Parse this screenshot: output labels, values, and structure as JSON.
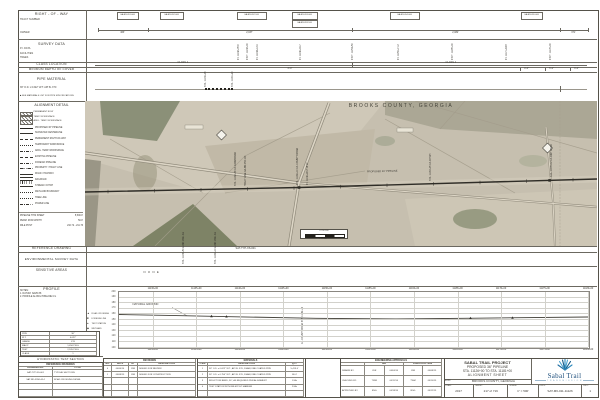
{
  "colors": {
    "paper": "#ffffff",
    "line": "#58554c",
    "map_base": "#c6bfaf",
    "woods": "#83886c",
    "pipeline": "#2f2d27",
    "brand_blue": "#1d4e7c",
    "brand_light": "#6d97b8",
    "grid": "#cfcec9"
  },
  "header": {
    "row_title": "RIGHT - OF - WAY",
    "row_sub1": "TRACT NUMBER",
    "row_sub2": "OWNER",
    "survey_title": "SURVEY DATA",
    "survey_sub1": "P.I. DATA",
    "survey_sub2": "FACILITIES",
    "survey_sub3": "TREES",
    "class_title": "CLASS LOCATION",
    "class_left": "CLASS 1",
    "class_right": "CLASS 1",
    "depth_title": "MINIMUM DEPTH OF COVER",
    "depth_main": "3'-0\"",
    "pipe_title": "PIPE MATERIAL",
    "pipe_item": "36\" O.D. x 0.622\" W.T. API 5L X70",
    "pipe_note": "■ SEE MATERIALS LIST FOR PIPE SPECIFICATIONS",
    "pipe_callout1": "STA. 11139+05",
    "pipe_callout2": "STA. 11141+90"
  },
  "row_tracts": {
    "boxes": [
      {
        "x": 31,
        "w": 20,
        "label": "GA-BR-051.000"
      },
      {
        "x": 74,
        "w": 22,
        "label": "GA-BR-052.000"
      },
      {
        "x": 151,
        "w": 28,
        "label": "GA-BR-052.100"
      },
      {
        "x": 206,
        "w": 24,
        "label": "GA-BR-053.000",
        "label2": "GA-BR-053.100"
      },
      {
        "x": 304,
        "w": 28,
        "label": "GA-BR-054.000"
      },
      {
        "x": 435,
        "w": 20,
        "label": "GA-BR-055.000"
      }
    ],
    "ticks": [
      12,
      62,
      266,
      474,
      502
    ],
    "dims": [
      {
        "x": 37,
        "t": "463'"
      },
      {
        "x": 164,
        "t": "2,037'"
      },
      {
        "x": 370,
        "t": "2,082'"
      },
      {
        "x": 488,
        "t": "371'"
      }
    ]
  },
  "survey": {
    "callouts": [
      {
        "x": 152,
        "t": "P.I. 11142+35.6"
      },
      {
        "x": 161,
        "t": "P.O.T. 11143+00"
      },
      {
        "x": 171,
        "t": "P.I. 11144+12.9"
      },
      {
        "x": 214,
        "t": "P.I. 11149+09.7"
      },
      {
        "x": 266,
        "t": "P.O.T. 11154+50"
      },
      {
        "x": 312,
        "t": "P.I. 11159+71.2"
      },
      {
        "x": 366,
        "t": "P.O.T. 11165+00"
      },
      {
        "x": 420,
        "t": "P.I. 11171+44.8"
      },
      {
        "x": 464,
        "t": "P.O.T. 11176+00"
      }
    ]
  },
  "depth_marks": [
    {
      "x": 441,
      "t": "4'-0\""
    },
    {
      "x": 466,
      "t": "5'-0\""
    },
    {
      "x": 491,
      "t": "3'-0\""
    }
  ],
  "legend": {
    "title": "ALIGNMENT DETAIL",
    "hatch": [
      {
        "t": "PERMANENT ROW"
      },
      {
        "t": "TEMP. WORKSPACE"
      },
      {
        "t": "ADDL. TEMP. WORKSPACE"
      }
    ],
    "items": [
      {
        "s": "thick",
        "t": "PROPOSED 36\" PIPELINE"
      },
      {
        "s": "solid",
        "t": "SURVEYED CENTERLINE"
      },
      {
        "s": "dashed",
        "t": "PERMANENT RIGHT-OF-WAY"
      },
      {
        "s": "dotted",
        "t": "TEMPORARY WORKSPACE"
      },
      {
        "s": "dashdot",
        "t": "ADDL. TEMP. WORKSPACE"
      },
      {
        "s": "dashed",
        "t": "EXISTING PIPELINE"
      },
      {
        "s": "dashdot",
        "t": "FOREIGN PIPELINE"
      },
      {
        "s": "dashdotdot",
        "t": "PROPERTY / TRACT LINE"
      },
      {
        "s": "double",
        "t": "ROAD / HIGHWAY"
      },
      {
        "s": "hatchline",
        "t": "RAILROAD"
      },
      {
        "s": "solid",
        "t": "STREAM / DITCH"
      },
      {
        "s": "dotted",
        "t": "WETLAND BOUNDARY"
      },
      {
        "s": "dotted",
        "t": "TREE LINE"
      },
      {
        "s": "dashdot",
        "t": "POWER LINE"
      }
    ],
    "totals": [
      {
        "l": "PIPELINE THIS SHEET",
        "v": "5,500.0'"
      },
      {
        "l": "PERM. ROW WIDTH",
        "v": "50.0'"
      },
      {
        "l": "MILE POST",
        "v": "210.72 - 211.76"
      }
    ]
  },
  "map": {
    "county": "BROOKS COUNTY, GEORGIA",
    "pipeline_label": "PROPOSED 36\" PIPELINE",
    "scale_nums": "0        250       500",
    "scale_text": "1\" = 500'",
    "callouts": [
      {
        "x": 150,
        "t": "STA. 11142+36  C/L FARM ROAD"
      },
      {
        "x": 160,
        "t": "TRACT LINE  GA-BR-052.100"
      },
      {
        "x": 212,
        "t": "STA. 11149+10  C/L COUNTY ROAD"
      },
      {
        "x": 222,
        "t": "P.I. 11149+96  2°14' LT."
      },
      {
        "x": 345,
        "t": "STA. 11163+05  C/L DITCH"
      },
      {
        "x": 466,
        "t": "STA. 11176+12  C/L DIRT ROAD"
      }
    ]
  },
  "bands": {
    "refdwg_title": "REFERENCE DRAWING",
    "refdwg_note": "SAT-TYP-XS-001",
    "env_title": "ENVIRONMENTAL SURVEY DATA",
    "env_callouts": [
      {
        "x": 97,
        "t": "STA. 11136+50  LAND USE: AG"
      },
      {
        "x": 129,
        "t": "STA. 11140+10  LAND USE: AG"
      }
    ],
    "sens_title": "SENSITIVE AREAS",
    "sens_value": "N O N E"
  },
  "profile": {
    "title": "PROFILE",
    "notes": [
      "NOTES:",
      "1. DATUM: NAVD 88",
      "2. PROFILE ALONG PIPELINE C/L"
    ],
    "symbols": [
      {
        "m": "▲",
        "t": "ROAD CROSSING"
      },
      {
        "m": "■",
        "t": "FOREIGN LINE"
      },
      {
        "m": "●",
        "t": "TEST STATION"
      },
      {
        "m": "◆",
        "t": "WETLAND"
      }
    ],
    "table": [
      [
        "PIPE",
        "36\""
      ],
      [
        "W.T.",
        "0.622\""
      ],
      [
        "GRADE",
        "X70"
      ],
      [
        "MAOP",
        "1,456 PSIG"
      ],
      [
        "TEST",
        "2,185 PSIG"
      ],
      [
        "CLASS",
        "1"
      ]
    ],
    "elevations": [
      "200",
      "190",
      "180",
      "170",
      "160",
      "150",
      "140",
      "130",
      "120",
      "110",
      "100"
    ],
    "stations": [
      "11130+00",
      "11135+00",
      "11140+00",
      "11145+00",
      "11150+00",
      "11155+00",
      "11160+00",
      "11165+00",
      "11170+00",
      "11175+00",
      "11180+00"
    ],
    "ground_label": "NATURAL GROUND",
    "crossing_callout": "C/L COUNTY ROAD  STA. 11149+10",
    "ground_elev_ft": 155
  },
  "hydro_title": "HYDROSTATIC TEST SECTION",
  "refdwgs": {
    "title": "REFERENCE DRAWINGS",
    "cols": [
      "DRAWING NO.",
      "TITLE"
    ],
    "rows": [
      [
        "SAT-TYP-XS-001",
        "TYPICAL SECTIONS"
      ],
      [
        "SAT-RD-XING-014",
        "ROAD CROSSING DETAIL"
      ],
      [
        "",
        ""
      ],
      [
        "",
        ""
      ]
    ]
  },
  "revisions": {
    "title": "REVISIONS",
    "cols": [
      "NO.",
      "DATE",
      "BY",
      "DESCRIPTION"
    ],
    "rows": [
      [
        "0",
        "04/04/14",
        "JDR",
        "ISSUED FOR REVIEW"
      ],
      [
        "1",
        "06/08/15",
        "JDR",
        "ISSUED FOR CONSTRUCTION"
      ],
      [
        "",
        "",
        "",
        ""
      ],
      [
        "",
        "",
        "",
        ""
      ],
      [
        "",
        "",
        "",
        ""
      ]
    ]
  },
  "materials": {
    "title": "MATERIALS",
    "cols": [
      "ITEM",
      "DESCRIPTION",
      "QTY."
    ],
    "rows": [
      [
        "1",
        "36\" O.D. x 0.622\" W.T., API 5L X70, DSAW, FBE COATED PIPE",
        "5,413.6'"
      ],
      [
        "2",
        "36\" O.D. x 0.750\" W.T., API 5L X70, DSAW, FBE COATED PIPE",
        "86.4'"
      ],
      [
        "3",
        "INDUCTION BEND, 36\", AS REQUIRED PER ALIGNMENT",
        "1 EA."
      ],
      [
        "4",
        "TEST STATION WITH MILEPOST MARKER",
        "2 EA."
      ],
      [
        "",
        "",
        ""
      ]
    ]
  },
  "approvals": {
    "title": "ENGINEERING APPROVALS",
    "bid": "BID",
    "construction": "CONSTRUCTION",
    "rows": [
      {
        "l": "DRAWN BY:",
        "bb": "JDR",
        "bd": "04/04/14",
        "cb": "JDR",
        "cd": "06/08/15"
      },
      {
        "l": "CHECKED BY:",
        "bb": "TWM",
        "bd": "04/11/14",
        "cb": "TWM",
        "cd": "06/10/15"
      },
      {
        "l": "APPROVED BY:",
        "bb": "RSG",
        "bd": "04/18/14",
        "cb": "RSG",
        "cd": "06/12/15"
      }
    ]
  },
  "titleblock": {
    "line1": "SABAL TRAIL PROJECT",
    "line2": "PROPOSED 36\" PIPELINE",
    "line3": "STA. 11126+00 TO STA. 11181+00",
    "line4": "ALIGNMENT SHEET",
    "loc_label": "LOC:",
    "loc_value": "BROOKS COUNTY, GEORGIA",
    "brand": "Sabal Trail",
    "brand_sub": "T R A N S M I S S I O N",
    "footer": [
      {
        "l": "YEAR:",
        "v": "2017"
      },
      {
        "l": "SHEET:",
        "v": "217 of 719"
      },
      {
        "l": "SCALE:",
        "v": "1\" = 500'"
      },
      {
        "l": "DWG:",
        "v": "SAT-M6-011-11126"
      },
      {
        "l": "REV:",
        "v": "1"
      }
    ]
  }
}
